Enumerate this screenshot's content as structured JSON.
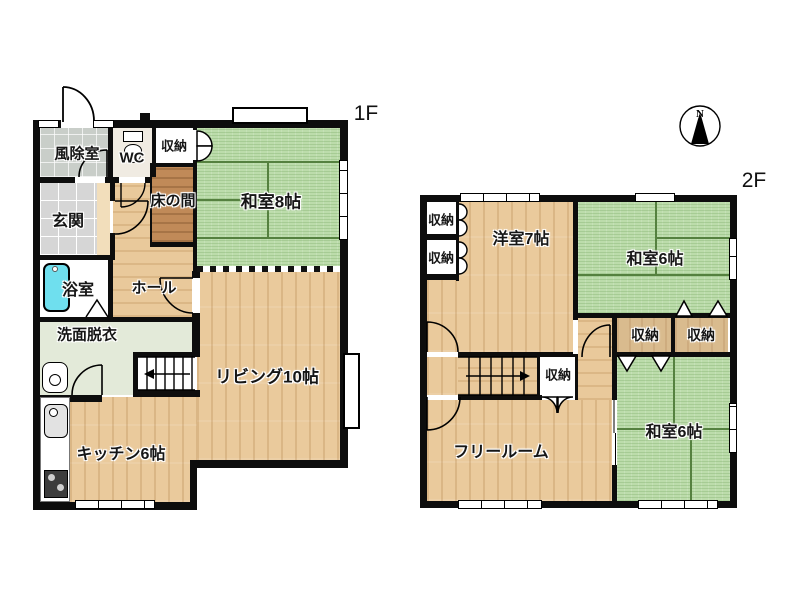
{
  "floor1": {
    "label": "1F",
    "rooms": {
      "windbreak": {
        "label": "風除室"
      },
      "wc": {
        "label": "WC"
      },
      "closet": {
        "label": "収納"
      },
      "tokonoma": {
        "label": "床の間"
      },
      "japanese8": {
        "label": "和室8帖"
      },
      "entrance": {
        "label": "玄関"
      },
      "bath": {
        "label": "浴室"
      },
      "hall": {
        "label": "ホール"
      },
      "washroom": {
        "label": "洗面脱衣"
      },
      "living": {
        "label": "リビング10帖"
      },
      "kitchen": {
        "label": "キッチン6帖"
      }
    }
  },
  "floor2": {
    "label": "2F",
    "rooms": {
      "closet_nw1": {
        "label": "収納"
      },
      "closet_nw2": {
        "label": "収納"
      },
      "western7": {
        "label": "洋室7帖"
      },
      "japanese6_north": {
        "label": "和室6帖"
      },
      "closet_mid_left": {
        "label": "収納"
      },
      "closet_mid_right": {
        "label": "収納"
      },
      "closet_stairs": {
        "label": "収納"
      },
      "freeroom": {
        "label": "フリールーム"
      },
      "japanese6_south": {
        "label": "和室6帖"
      }
    }
  },
  "compass": {
    "label": "N"
  },
  "colors": {
    "wall": "#0d0d0d",
    "tatami": "#bcdcab",
    "tatami_grid": "#55813f",
    "wood": "#eaca9c",
    "tokonoma_wood": "#c08a58",
    "entrance_tile": "#d6d6d6",
    "windbreak": "#c9cec9",
    "washroom": "#e3ead9",
    "bathtub": "#6fdfee",
    "closet_tan": "#d9bb8e"
  }
}
